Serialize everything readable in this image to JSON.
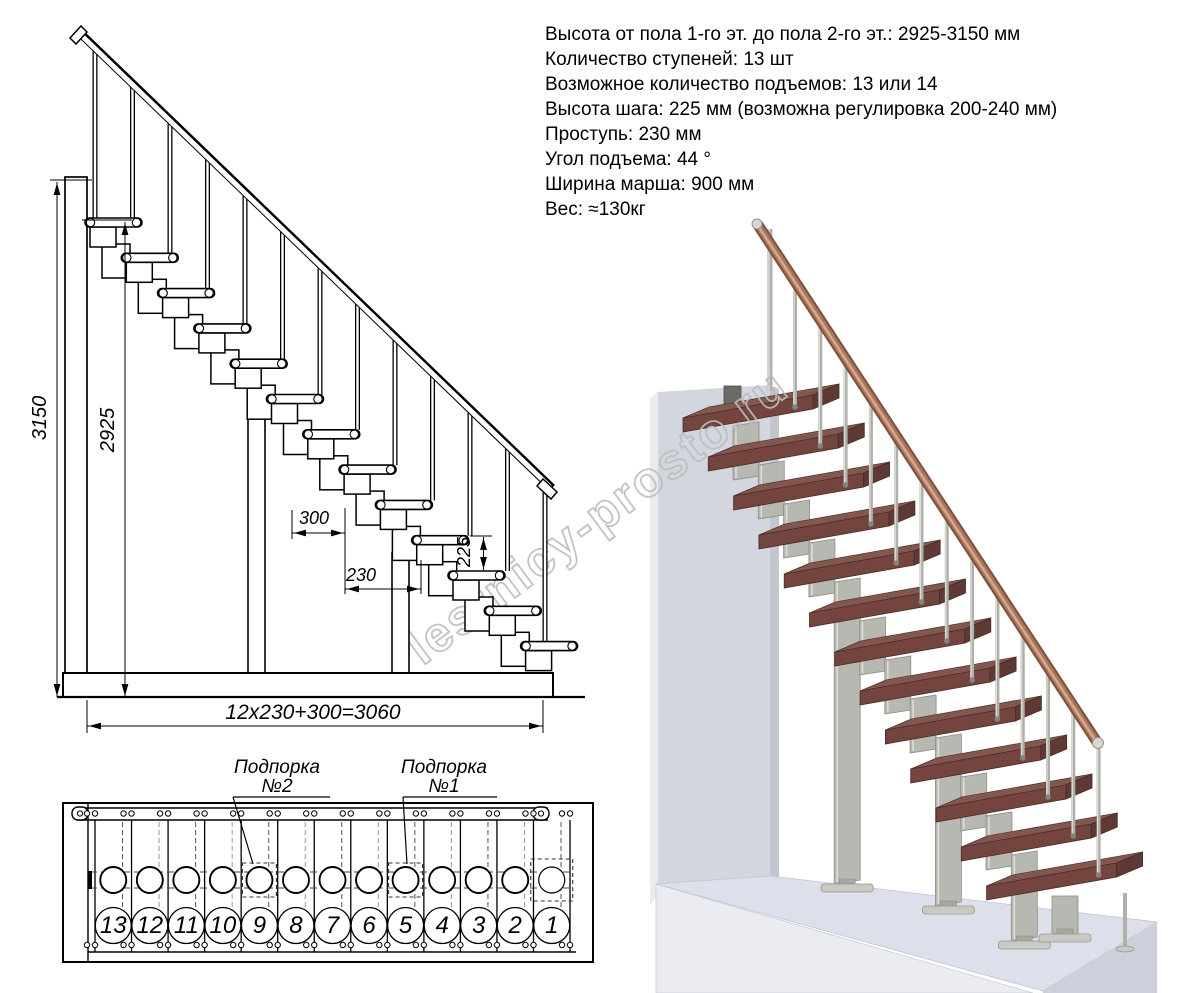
{
  "specs": {
    "lines": [
      "Высота от пола 1-го эт. до пола 2-го эт.: 2925-3150 мм",
      "Количество ступеней: 13 шт",
      "Возможное количество подъемов: 13 или 14",
      "Высота шага: 225 мм (возможна регулировка 200-240 мм)",
      "Проступь: 230 мм",
      "Угол подъема: 44 °",
      "Ширина марша: 900 мм",
      "Вес: ≈130кг"
    ]
  },
  "dims": {
    "floor_to_floor": "3150",
    "floor_to_top_step": "2925",
    "platform_run": "300",
    "tread_run": "230",
    "step_height": "225",
    "total_run": "12x230+300=3060"
  },
  "plan": {
    "supports": [
      {
        "title": "Подпорка",
        "number": "№2"
      },
      {
        "title": "Подпорка",
        "number": "№1"
      }
    ],
    "steps": [
      "13",
      "12",
      "11",
      "10",
      "9",
      "8",
      "7",
      "6",
      "5",
      "4",
      "3",
      "2",
      "1"
    ]
  },
  "side_view": {
    "steps_count": 13
  },
  "watermark": "lestnicy-prosto.ru",
  "colors": {
    "line": "#000000",
    "wood_top": "#8e6159",
    "wood_front": "#74453f",
    "wood_side": "#5f3a34",
    "rail_dark": "#7e503e",
    "rail_mid": "#a8765c",
    "rail_light": "#d4a88c",
    "metal": "#b7b8b1",
    "metal_dark": "#8e8f88",
    "metal_light": "#dfdfda",
    "flange": "#c9cac3",
    "wall": "#d3d6de",
    "wall_side": "#c3c6ce",
    "wall_light": "#e9ebef",
    "floor_top": "#dde0ea",
    "floor_front": "#eaecf2",
    "floor_side": "#ccd0da",
    "watermark": "#bdbdbd"
  }
}
